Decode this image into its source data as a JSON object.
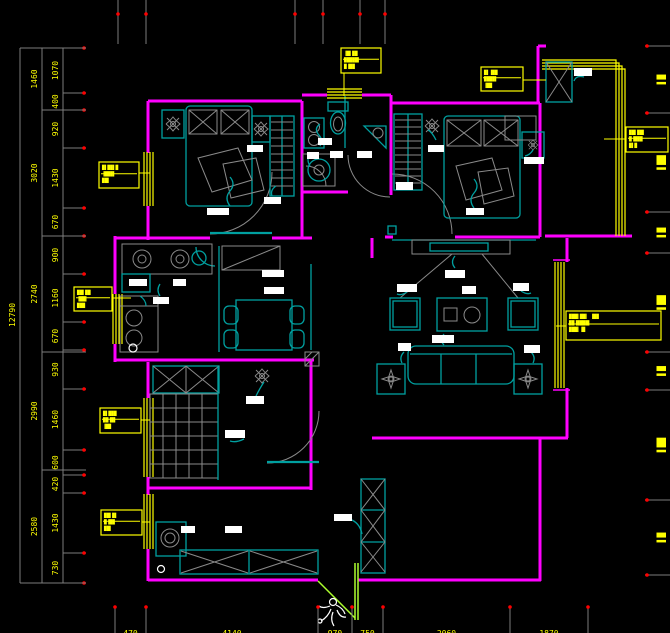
{
  "drawing_colors": {
    "background": "#000000",
    "walls": "#FF00FF",
    "furniture": "#00A0A0",
    "windows": "#FFFF00",
    "dimension_text": "#FFFF00",
    "dimension_lines": "#7D7D7D",
    "tick_dots": "#FF0000",
    "text_tags": "#FFFFFF",
    "entry_door_swing": "#ADFF2F"
  },
  "dimensions": {
    "left_total": "12790",
    "left_outer": [
      "1460",
      "3020",
      "2740",
      "2990",
      "2580"
    ],
    "left_inner": [
      "1070",
      "400",
      "920",
      "1430",
      "670",
      "900",
      "1160",
      "670",
      "930",
      "1460",
      "600",
      "420",
      "1430",
      "730"
    ],
    "bottom": [
      "470",
      "4140",
      "970",
      "750",
      "2060",
      "1870"
    ],
    "right": [
      "▌█",
      "▌██",
      "▌█",
      "▌██",
      "▌█",
      "▌██",
      "▌█"
    ]
  },
  "callouts": [
    {
      "lines": [
        "█▌██▌█",
        "▐███▌",
        "██▌"
      ]
    },
    {
      "lines": [
        "██▌██",
        "▐██▌",
        "███"
      ]
    },
    {
      "lines": [
        "█▌███",
        "██▐█▌",
        "▐██"
      ]
    },
    {
      "lines": [
        "██▌█▌",
        "█▐██",
        "██▌"
      ]
    },
    {
      "lines": [
        "▐█▌██",
        "█████▌",
        "█▐██"
      ]
    },
    {
      "lines": [
        "█▌▐██",
        "████▌",
        "▐██"
      ]
    },
    {
      "lines": [
        "██▌██▌",
        "█▐███",
        "█▌█"
      ]
    },
    {
      "lines": [
        "███▌██▌ ▐██",
        "██▐████▌",
        "███▌▐█"
      ]
    }
  ]
}
